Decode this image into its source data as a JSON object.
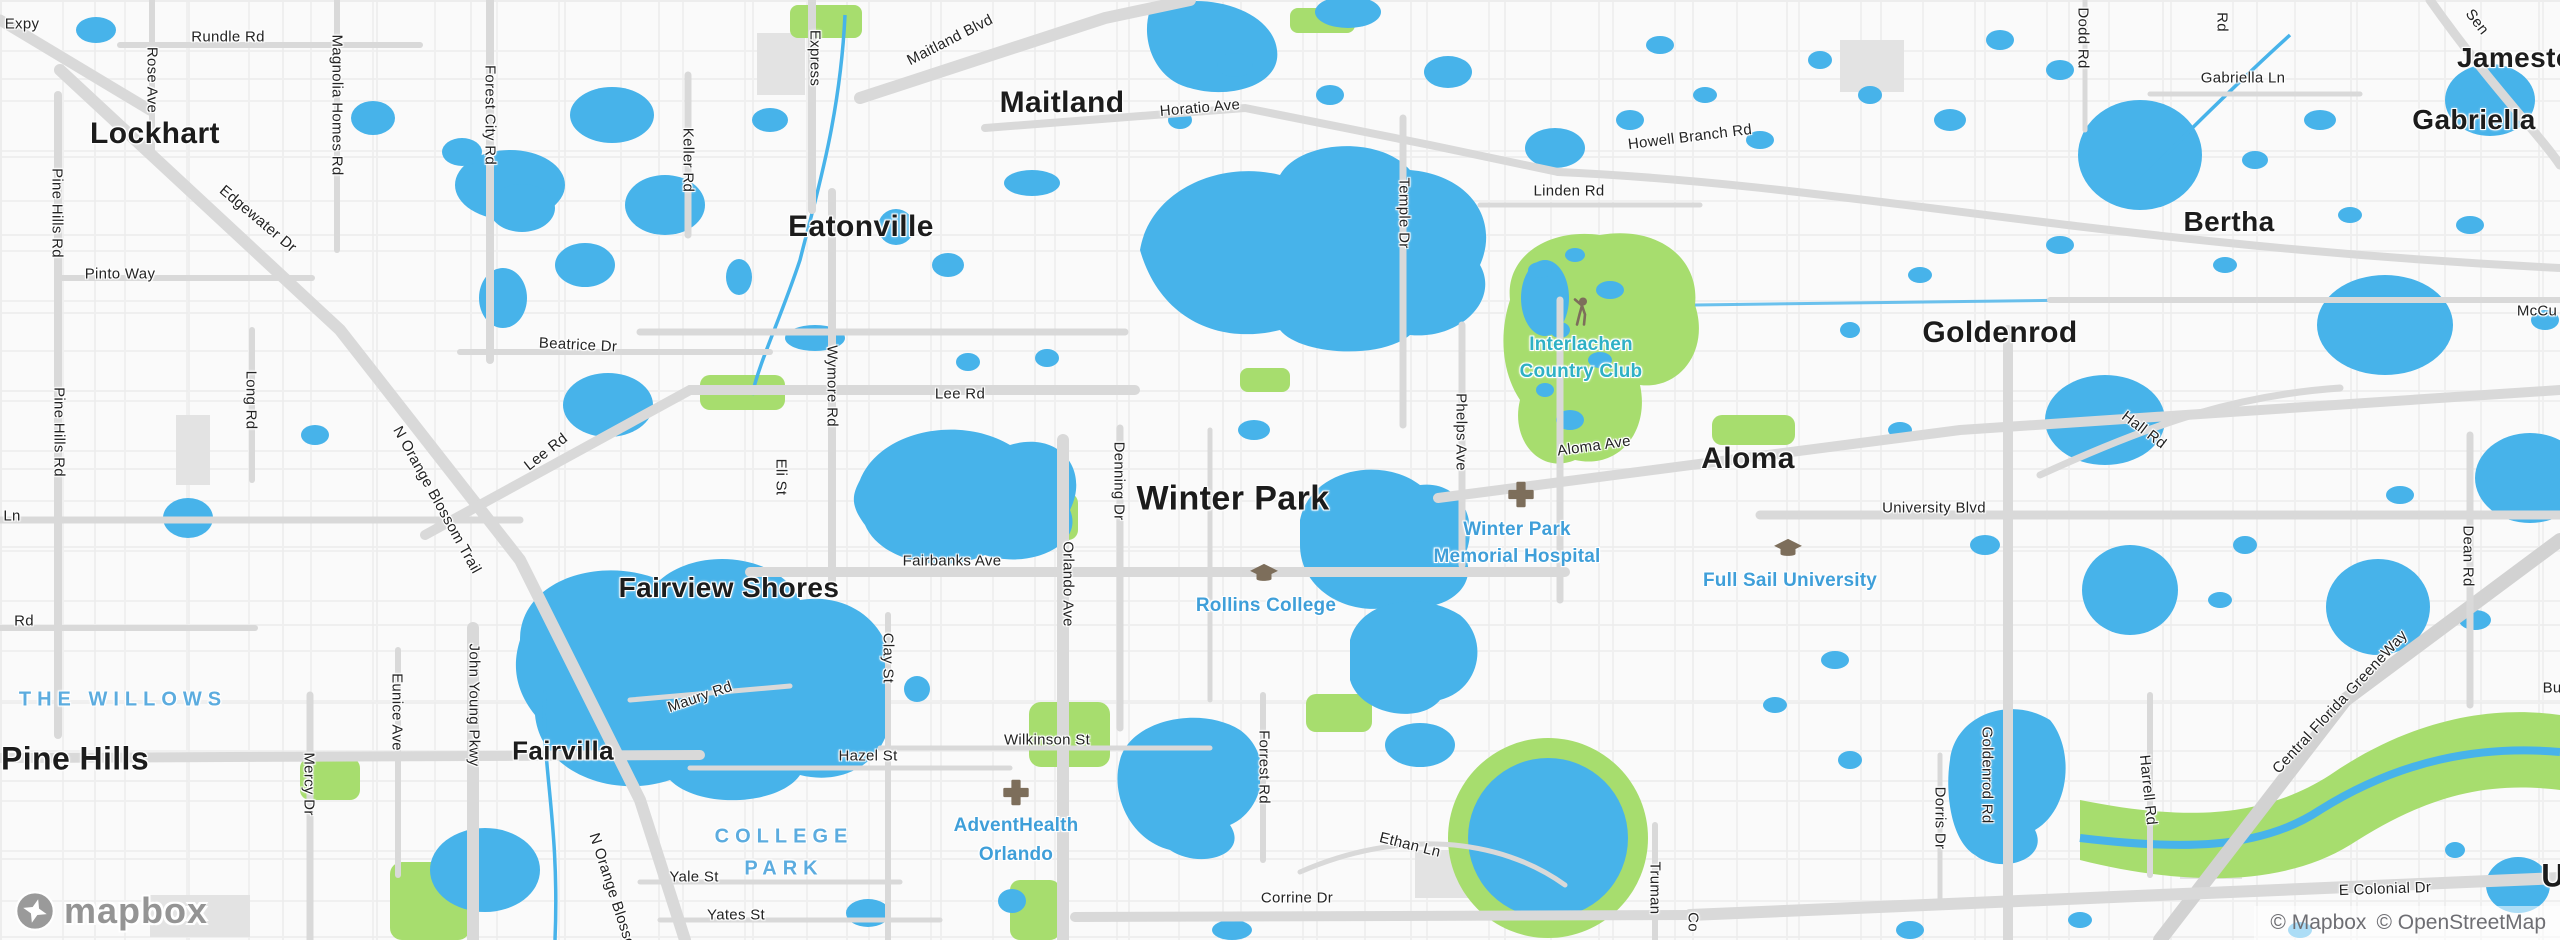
{
  "map": {
    "places": [
      "Lockhart",
      "Maitland",
      "Eatonville",
      "Winter Park",
      "Fairview Shores",
      "Pine Hills",
      "Fairvilla",
      "Aloma",
      "Goldenrod",
      "Bertha",
      "Gabriella",
      "Jamestown",
      "U"
    ],
    "neighborhoods": [
      "THE WILLOWS",
      "COLLEGE",
      "PARK"
    ],
    "pois": [
      {
        "lines": [
          "Interlachen",
          "Country Club"
        ],
        "icon": "golf-icon"
      },
      {
        "lines": [
          "Winter Park",
          "Memorial Hospital"
        ],
        "icon": "hospital-cross-icon"
      },
      {
        "lines": [
          "Rollins College"
        ],
        "icon": "college-icon"
      },
      {
        "lines": [
          "Full Sail University"
        ],
        "icon": "college-icon"
      },
      {
        "lines": [
          "AdventHealth",
          "Orlando"
        ],
        "icon": "hospital-cross-icon"
      }
    ],
    "roads": [
      "Expy",
      "Rundle Rd",
      "Rose Ave",
      "Magnolia Homes Rd",
      "Forest City Rd",
      "Express",
      "Maitland Blvd",
      "Keller Rd",
      "Horatio Ave",
      "Temple Dr",
      "Linden Rd",
      "Howell Branch Rd",
      "Gabriella Ln",
      "Dodd Rd",
      "Rd",
      "Sen",
      "McCu",
      "Pine Hills Rd",
      "Pine Hills Rd",
      "Edgewater Dr",
      "Pinto Way",
      "Beatrice Dr",
      "Lee Rd",
      "Wymore Rd",
      "Long Rd",
      "N Orange Blossom Trail",
      "Lee Rd",
      "Eli St",
      "Ln",
      "Rd",
      "Denning Dr",
      "Orlando Ave",
      "Phelps Ave",
      "Aloma Ave",
      "University Blvd",
      "Hall Rd",
      "Dean Rd",
      "Fairbanks Ave",
      "Maury Rd",
      "Clay St",
      "Hazel St",
      "Wilkinson St",
      "Eunice Ave",
      "John Young Pkwy",
      "Mercy Dr",
      "Forrest Rd",
      "N Orange Blosso",
      "Yale St",
      "Yates St",
      "Ethan Ln",
      "Corrine Dr",
      "Truman",
      "Co",
      "Goldenrod Rd",
      "Dorris Dr",
      "Harrell Rd",
      "Central Florida GreeneWay",
      "E Colonial Dr",
      "Buc"
    ],
    "attribution": {
      "mapbox": "© Mapbox",
      "osm": "© OpenStreetMap"
    },
    "logo": "mapbox",
    "colors": {
      "water": "#47b3ea",
      "park": "#a7dd6e",
      "road": "#d9d9d9",
      "poi_blue": "#3f9fd9",
      "poi_teal": "#2fb1c5",
      "neighborhood": "#5cacdf",
      "icon_brown": "#7d6e5b"
    }
  }
}
